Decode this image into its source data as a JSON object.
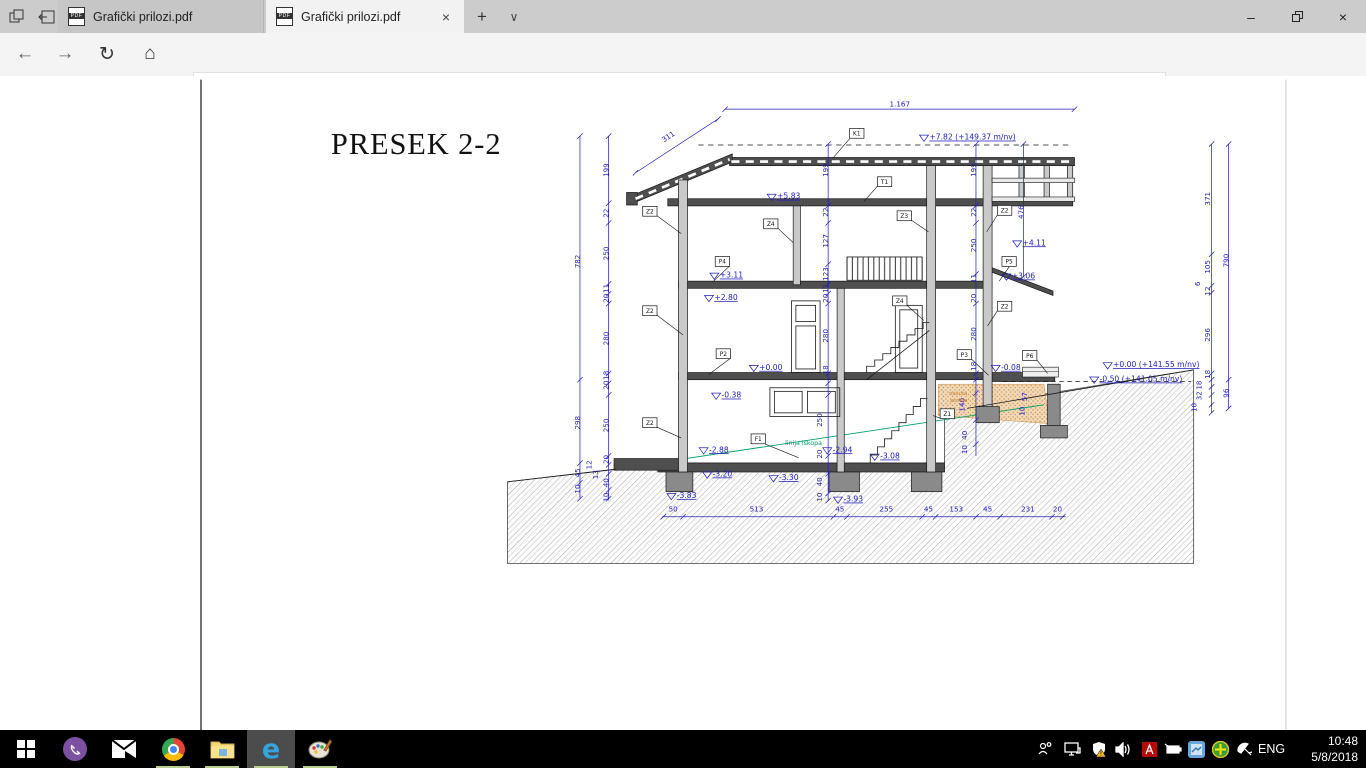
{
  "browser": {
    "tabs": [
      {
        "label": "Grafički prilozi.pdf"
      },
      {
        "label": "Grafički prilozi.pdf"
      }
    ],
    "pdf_badge": "PDF",
    "url": "file:///D:/zorica/kuca/IDEJNO%20RESENJE/Grafički%20prilozi.pdf",
    "icons": {
      "back": "←",
      "forward": "→",
      "refresh": "↻",
      "home": "⌂",
      "star": "☆",
      "more": "···",
      "new_tab": "+",
      "tab_chevron": "∨",
      "tab_close": "×",
      "minimize": "–",
      "close": "×",
      "info": "i"
    }
  },
  "taskbar": {
    "lang": "ENG",
    "time": "10:48",
    "date": "5/8/2018"
  },
  "drawing": {
    "title": "PRESEK 2-2",
    "annotations": [
      {
        "x": 925,
        "y": 110,
        "t": "1.167"
      },
      {
        "x": 668,
        "y": 146,
        "t": "311",
        "r": -33
      },
      {
        "x": 672,
        "y": 562,
        "t": "50"
      },
      {
        "x": 765,
        "y": 562,
        "t": "513"
      },
      {
        "x": 858,
        "y": 562,
        "t": "45"
      },
      {
        "x": 910,
        "y": 562,
        "t": "255"
      },
      {
        "x": 957,
        "y": 562,
        "t": "45"
      },
      {
        "x": 988,
        "y": 562,
        "t": "153"
      },
      {
        "x": 1023,
        "y": 562,
        "t": "45"
      },
      {
        "x": 1068,
        "y": 562,
        "t": "231"
      },
      {
        "x": 1101,
        "y": 562,
        "t": "20"
      },
      {
        "x": 568,
        "y": 283,
        "t": "782",
        "r": -90
      },
      {
        "x": 568,
        "y": 463,
        "t": "298",
        "r": -90
      },
      {
        "x": 568,
        "y": 519,
        "t": "45",
        "r": -90
      },
      {
        "x": 568,
        "y": 537,
        "t": "10",
        "r": -90
      },
      {
        "x": 581,
        "y": 510,
        "t": "12",
        "r": -90
      },
      {
        "x": 588,
        "y": 521,
        "t": "13",
        "r": -90
      },
      {
        "x": 600,
        "y": 181,
        "t": "199",
        "r": -90
      },
      {
        "x": 600,
        "y": 229,
        "t": "22",
        "r": -90
      },
      {
        "x": 600,
        "y": 274,
        "t": "250",
        "r": -90
      },
      {
        "x": 600,
        "y": 313,
        "t": "11",
        "r": -90
      },
      {
        "x": 600,
        "y": 324,
        "t": "20",
        "r": -90
      },
      {
        "x": 600,
        "y": 369,
        "t": "280",
        "r": -90
      },
      {
        "x": 600,
        "y": 410,
        "t": "18",
        "r": -90
      },
      {
        "x": 600,
        "y": 421,
        "t": "20",
        "r": -90
      },
      {
        "x": 600,
        "y": 466,
        "t": "250",
        "r": -90
      },
      {
        "x": 600,
        "y": 504,
        "t": "20",
        "r": -90
      },
      {
        "x": 600,
        "y": 530,
        "t": "40",
        "r": -90
      },
      {
        "x": 600,
        "y": 546,
        "t": "10",
        "r": -90
      },
      {
        "x": 845,
        "y": 181,
        "t": "199",
        "r": -90
      },
      {
        "x": 845,
        "y": 228,
        "t": "22",
        "r": -90
      },
      {
        "x": 845,
        "y": 260,
        "t": "127",
        "r": -90
      },
      {
        "x": 845,
        "y": 297,
        "t": "123",
        "r": -90
      },
      {
        "x": 845,
        "y": 313,
        "t": "11",
        "r": -90
      },
      {
        "x": 845,
        "y": 324,
        "t": "20",
        "r": -90
      },
      {
        "x": 845,
        "y": 366,
        "t": "280",
        "r": -90
      },
      {
        "x": 845,
        "y": 404,
        "t": "18",
        "r": -90
      },
      {
        "x": 838,
        "y": 460,
        "t": "250",
        "r": -90
      },
      {
        "x": 838,
        "y": 498,
        "t": "20",
        "r": -90
      },
      {
        "x": 838,
        "y": 529,
        "t": "40",
        "r": -90
      },
      {
        "x": 838,
        "y": 546,
        "t": "10",
        "r": -90
      },
      {
        "x": 1010,
        "y": 181,
        "t": "199",
        "r": -90
      },
      {
        "x": 1010,
        "y": 228,
        "t": "22",
        "r": -90
      },
      {
        "x": 1010,
        "y": 265,
        "t": "250",
        "r": -90
      },
      {
        "x": 1010,
        "y": 302,
        "t": "11",
        "r": -90
      },
      {
        "x": 1010,
        "y": 324,
        "t": "20",
        "r": -90
      },
      {
        "x": 1010,
        "y": 364,
        "t": "280",
        "r": -90
      },
      {
        "x": 1010,
        "y": 400,
        "t": "18",
        "r": -90
      },
      {
        "x": 997,
        "y": 443,
        "t": "140",
        "r": -90
      },
      {
        "x": 1000,
        "y": 477,
        "t": "40",
        "r": -90
      },
      {
        "x": 1000,
        "y": 493,
        "t": "10",
        "r": -90
      },
      {
        "x": 1067,
        "y": 434,
        "t": "57",
        "r": -90
      },
      {
        "x": 1064,
        "y": 450,
        "t": "10",
        "r": -90
      },
      {
        "x": 1063,
        "y": 228,
        "t": "476",
        "r": -90
      },
      {
        "x": 1271,
        "y": 213,
        "t": "371",
        "r": -90
      },
      {
        "x": 1271,
        "y": 289,
        "t": "105",
        "r": -90
      },
      {
        "x": 1271,
        "y": 316,
        "t": "12",
        "r": -90
      },
      {
        "x": 1260,
        "y": 308,
        "t": "6",
        "r": -90
      },
      {
        "x": 1271,
        "y": 365,
        "t": "296",
        "r": -90
      },
      {
        "x": 1271,
        "y": 409,
        "t": "18",
        "r": -90
      },
      {
        "x": 1262,
        "y": 421,
        "t": "18",
        "r": -90
      },
      {
        "x": 1262,
        "y": 433,
        "t": "32",
        "r": -90
      },
      {
        "x": 1256,
        "y": 446,
        "t": "10",
        "r": -90
      },
      {
        "x": 1292,
        "y": 282,
        "t": "790",
        "r": -90
      },
      {
        "x": 1292,
        "y": 430,
        "t": "96",
        "r": -90
      },
      {
        "x": 958,
        "y": 147,
        "t": "+7.82 (+149.37 m/nv)",
        "c": "lvl"
      },
      {
        "x": 788,
        "y": 213,
        "t": "+5.83",
        "c": "lvl"
      },
      {
        "x": 724,
        "y": 301,
        "t": "+3.11",
        "c": "lvl"
      },
      {
        "x": 718,
        "y": 326,
        "t": "+2.80",
        "c": "lvl"
      },
      {
        "x": 768,
        "y": 404,
        "t": "+0.00",
        "c": "lvl"
      },
      {
        "x": 726,
        "y": 435,
        "t": "-0.38",
        "c": "lvl"
      },
      {
        "x": 1062,
        "y": 265,
        "t": "+4.11",
        "c": "lvl"
      },
      {
        "x": 1050,
        "y": 302,
        "t": "+3.06",
        "c": "lvl"
      },
      {
        "x": 1038,
        "y": 404,
        "t": "-0.08",
        "c": "lvl"
      },
      {
        "x": 1163,
        "y": 401,
        "t": "+0.00 (+141.55 m/nv)",
        "c": "lvl"
      },
      {
        "x": 1148,
        "y": 417,
        "t": "-0.50 (+141.05 m/nv)",
        "c": "lvl"
      },
      {
        "x": 712,
        "y": 496,
        "t": "-2.88",
        "c": "lvl"
      },
      {
        "x": 850,
        "y": 496,
        "t": "-2.94",
        "c": "lvl"
      },
      {
        "x": 903,
        "y": 503,
        "t": "-3.08",
        "c": "lvl"
      },
      {
        "x": 716,
        "y": 523,
        "t": "-3.20",
        "c": "lvl"
      },
      {
        "x": 790,
        "y": 527,
        "t": "-3.30",
        "c": "lvl"
      },
      {
        "x": 676,
        "y": 547,
        "t": "-3.83",
        "c": "lvl"
      },
      {
        "x": 862,
        "y": 551,
        "t": "-3.93",
        "c": "lvl"
      },
      {
        "x": 797,
        "y": 488,
        "t": "linija iskopa",
        "c": "g"
      },
      {
        "x": 980,
        "y": 432,
        "t": "nasuta",
        "c": "o"
      },
      {
        "x": 981,
        "y": 440,
        "t": "zemlja",
        "c": "o"
      }
    ],
    "boxes": [
      {
        "x": 877,
        "y": 140,
        "t": "K1"
      },
      {
        "x": 908,
        "y": 194,
        "t": "T1"
      },
      {
        "x": 646,
        "y": 227,
        "t": "Z2"
      },
      {
        "x": 646,
        "y": 338,
        "t": "Z2"
      },
      {
        "x": 646,
        "y": 463,
        "t": "Z2"
      },
      {
        "x": 781,
        "y": 241,
        "t": "Z4"
      },
      {
        "x": 930,
        "y": 232,
        "t": "Z3"
      },
      {
        "x": 925,
        "y": 327,
        "t": "Z4"
      },
      {
        "x": 1042,
        "y": 226,
        "t": "Z2"
      },
      {
        "x": 1042,
        "y": 333,
        "t": "Z2"
      },
      {
        "x": 727,
        "y": 283,
        "t": "P4"
      },
      {
        "x": 728,
        "y": 386,
        "t": "P2"
      },
      {
        "x": 997,
        "y": 387,
        "t": "P3"
      },
      {
        "x": 1047,
        "y": 283,
        "t": "P5"
      },
      {
        "x": 1070,
        "y": 388,
        "t": "P6"
      },
      {
        "x": 978,
        "y": 453,
        "t": "Z1"
      },
      {
        "x": 767,
        "y": 481,
        "t": "F1"
      }
    ]
  }
}
